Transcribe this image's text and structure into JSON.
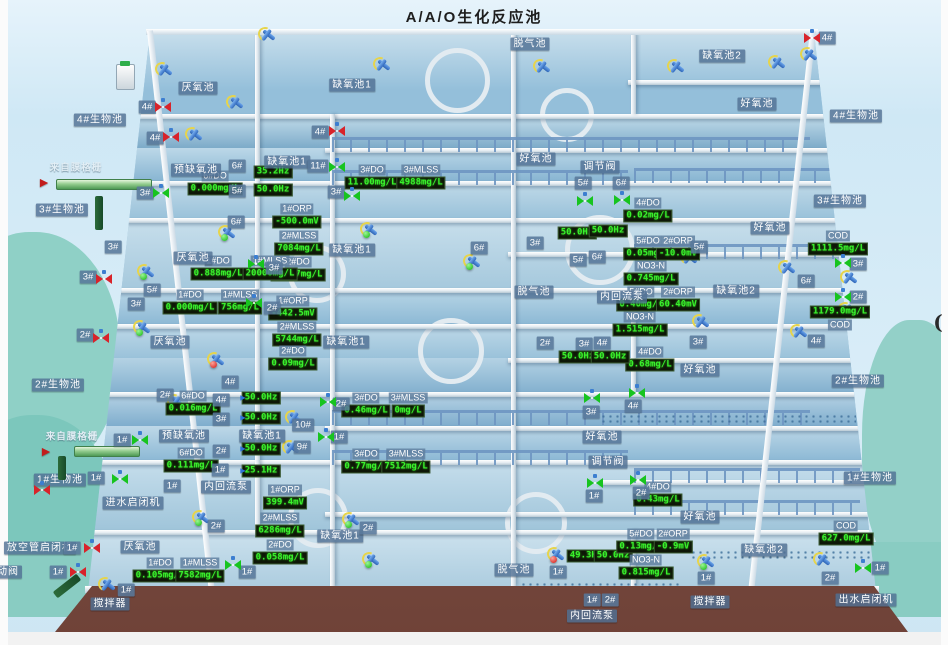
{
  "title": "A/A/O生化反应池",
  "colors": {
    "led_text": "#39f12c",
    "led_bg": "#0e1607",
    "tag_bg": "#58789a",
    "valve_open": "#17c41f",
    "valve_closed": "#d8232a",
    "status_ok": "#0fb30c",
    "status_alarm": "#d01310",
    "water": "#9dc3da"
  },
  "labels": [
    {
      "text": "脱气池",
      "x": 530,
      "y": 44
    },
    {
      "text": "缺氧池2",
      "x": 722,
      "y": 56
    },
    {
      "text": "缺氧池1",
      "x": 352,
      "y": 85
    },
    {
      "text": "厌氧池",
      "x": 198,
      "y": 88
    },
    {
      "text": "好氧池",
      "x": 757,
      "y": 104
    },
    {
      "text": "4#生物池",
      "x": 100,
      "y": 120
    },
    {
      "text": "4#生物池",
      "x": 856,
      "y": 116
    },
    {
      "text": "好氧池",
      "x": 536,
      "y": 159
    },
    {
      "text": "调节阀",
      "x": 600,
      "y": 167
    },
    {
      "text": "缺氧池1",
      "x": 287,
      "y": 162
    },
    {
      "text": "预缺氧池",
      "x": 196,
      "y": 170
    },
    {
      "text": "来自膜格栅",
      "x": 76,
      "y": 168,
      "variant": "plain"
    },
    {
      "text": "3#生物池",
      "x": 62,
      "y": 210
    },
    {
      "text": "3#生物池",
      "x": 840,
      "y": 201
    },
    {
      "text": "好氧池",
      "x": 770,
      "y": 228
    },
    {
      "text": "厌氧池",
      "x": 193,
      "y": 258
    },
    {
      "text": "缺氧池1",
      "x": 352,
      "y": 250
    },
    {
      "text": "脱气池",
      "x": 534,
      "y": 292
    },
    {
      "text": "内回流泵",
      "x": 622,
      "y": 297
    },
    {
      "text": "缺氧池2",
      "x": 736,
      "y": 291
    },
    {
      "text": "厌氧池",
      "x": 170,
      "y": 342
    },
    {
      "text": "缺氧池1",
      "x": 346,
      "y": 342
    },
    {
      "text": "好氧池",
      "x": 700,
      "y": 370
    },
    {
      "text": "2#生物池",
      "x": 58,
      "y": 385
    },
    {
      "text": "2#生物池",
      "x": 858,
      "y": 381
    },
    {
      "text": "预缺氧池",
      "x": 184,
      "y": 436
    },
    {
      "text": "缺氧池1",
      "x": 262,
      "y": 436
    },
    {
      "text": "好氧池",
      "x": 602,
      "y": 437
    },
    {
      "text": "调节阀",
      "x": 608,
      "y": 462
    },
    {
      "text": "来自膜格栅",
      "x": 72,
      "y": 437,
      "variant": "plain"
    },
    {
      "text": "1#生物池",
      "x": 60,
      "y": 480
    },
    {
      "text": "1#生物池",
      "x": 870,
      "y": 478
    },
    {
      "text": "内回流泵",
      "x": 226,
      "y": 487
    },
    {
      "text": "进水启闭机",
      "x": 133,
      "y": 503
    },
    {
      "text": "厌氧池",
      "x": 140,
      "y": 547
    },
    {
      "text": "缺氧池1",
      "x": 340,
      "y": 536
    },
    {
      "text": "好氧池",
      "x": 700,
      "y": 517
    },
    {
      "text": "脱气池",
      "x": 514,
      "y": 570
    },
    {
      "text": "缺氧池2",
      "x": 764,
      "y": 550
    },
    {
      "text": "放空管启闭机",
      "x": 40,
      "y": 548
    },
    {
      "text": "放空管电动阀",
      "x": -14,
      "y": 572
    },
    {
      "text": "搅拌器",
      "x": 110,
      "y": 604
    },
    {
      "text": "内回流泵",
      "x": 592,
      "y": 616
    },
    {
      "text": "搅拌器",
      "x": 710,
      "y": 602
    },
    {
      "text": "出水启闭机",
      "x": 866,
      "y": 600
    },
    {
      "text": "(",
      "x": 938,
      "y": 322,
      "variant": "mark"
    },
    {
      "text": "4#",
      "x": 147,
      "y": 107
    },
    {
      "text": "4#",
      "x": 155,
      "y": 138
    },
    {
      "text": "4#",
      "x": 320,
      "y": 132
    },
    {
      "text": "4#",
      "x": 827,
      "y": 38
    },
    {
      "text": "3#",
      "x": 145,
      "y": 193
    },
    {
      "text": "6#",
      "x": 237,
      "y": 166
    },
    {
      "text": "5#",
      "x": 237,
      "y": 191
    },
    {
      "text": "11#",
      "x": 318,
      "y": 166
    },
    {
      "text": "3#",
      "x": 336,
      "y": 192
    },
    {
      "text": "5#",
      "x": 583,
      "y": 183
    },
    {
      "text": "6#",
      "x": 621,
      "y": 183
    },
    {
      "text": "3#",
      "x": 113,
      "y": 247
    },
    {
      "text": "3#",
      "x": 88,
      "y": 277
    },
    {
      "text": "2#",
      "x": 85,
      "y": 335
    },
    {
      "text": "6#",
      "x": 236,
      "y": 222
    },
    {
      "text": "5#",
      "x": 152,
      "y": 290
    },
    {
      "text": "3#",
      "x": 274,
      "y": 268
    },
    {
      "text": "2#",
      "x": 272,
      "y": 308
    },
    {
      "text": "3#",
      "x": 136,
      "y": 304
    },
    {
      "text": "6#",
      "x": 479,
      "y": 248
    },
    {
      "text": "3#",
      "x": 535,
      "y": 243
    },
    {
      "text": "5#",
      "x": 578,
      "y": 260
    },
    {
      "text": "6#",
      "x": 597,
      "y": 257
    },
    {
      "text": "2#",
      "x": 545,
      "y": 343
    },
    {
      "text": "3#",
      "x": 584,
      "y": 344
    },
    {
      "text": "4#",
      "x": 602,
      "y": 343
    },
    {
      "text": "5#",
      "x": 699,
      "y": 247
    },
    {
      "text": "3#",
      "x": 698,
      "y": 342
    },
    {
      "text": "6#",
      "x": 806,
      "y": 281
    },
    {
      "text": "4#",
      "x": 816,
      "y": 341
    },
    {
      "text": "3#",
      "x": 858,
      "y": 264
    },
    {
      "text": "2#",
      "x": 858,
      "y": 297
    },
    {
      "text": "4#",
      "x": 230,
      "y": 382
    },
    {
      "text": "2#",
      "x": 165,
      "y": 395
    },
    {
      "text": "4#",
      "x": 221,
      "y": 400
    },
    {
      "text": "3#",
      "x": 221,
      "y": 419
    },
    {
      "text": "2#",
      "x": 221,
      "y": 451
    },
    {
      "text": "1#",
      "x": 220,
      "y": 470
    },
    {
      "text": "1#",
      "x": 122,
      "y": 440
    },
    {
      "text": "1#",
      "x": 96,
      "y": 478
    },
    {
      "text": "10#",
      "x": 303,
      "y": 425
    },
    {
      "text": "9#",
      "x": 302,
      "y": 447
    },
    {
      "text": "1#",
      "x": 172,
      "y": 486
    },
    {
      "text": "2#",
      "x": 341,
      "y": 404
    },
    {
      "text": "1#",
      "x": 339,
      "y": 437
    },
    {
      "text": "3#",
      "x": 591,
      "y": 412
    },
    {
      "text": "1#",
      "x": 594,
      "y": 496
    },
    {
      "text": "4#",
      "x": 633,
      "y": 406
    },
    {
      "text": "2#",
      "x": 641,
      "y": 493
    },
    {
      "text": "2#",
      "x": 216,
      "y": 526
    },
    {
      "text": "2#",
      "x": 368,
      "y": 528
    },
    {
      "text": "1#",
      "x": 126,
      "y": 590
    },
    {
      "text": "1#",
      "x": 72,
      "y": 548
    },
    {
      "text": "1#",
      "x": 58,
      "y": 572
    },
    {
      "text": "1#",
      "x": 247,
      "y": 572
    },
    {
      "text": "1#",
      "x": 558,
      "y": 572
    },
    {
      "text": "1#",
      "x": 592,
      "y": 600
    },
    {
      "text": "2#",
      "x": 610,
      "y": 600
    },
    {
      "text": "1#",
      "x": 706,
      "y": 578
    },
    {
      "text": "1#",
      "x": 880,
      "y": 568
    },
    {
      "text": "2#",
      "x": 830,
      "y": 578
    }
  ],
  "sensors": [
    {
      "label": "6#DO",
      "value": "0.000mg/L",
      "x": 215,
      "y": 183
    },
    {
      "value": "35.2Hz",
      "x": 273,
      "y": 172
    },
    {
      "value": "50.0Hz",
      "x": 273,
      "y": 190
    },
    {
      "label": "3#DO",
      "value": "11.00mg/L",
      "x": 372,
      "y": 177
    },
    {
      "label": "3#MLSS",
      "value": "4988mg/L",
      "x": 421,
      "y": 177
    },
    {
      "label": "1#ORP",
      "value": "-500.0mV",
      "x": 297,
      "y": 216
    },
    {
      "label": "2#MLSS",
      "value": "7084mg/L",
      "x": 299,
      "y": 243
    },
    {
      "label": "2#DO",
      "value": "10.17mg/L",
      "x": 298,
      "y": 269
    },
    {
      "label": "1#DO",
      "value": "0.888mg/L",
      "x": 218,
      "y": 268
    },
    {
      "label": "1#MLSS",
      "value": "20000mg/L",
      "x": 270,
      "y": 268
    },
    {
      "label": "1#DO",
      "value": "0.000mg/L",
      "x": 190,
      "y": 302
    },
    {
      "label": "1#MLSS",
      "value": "756mg/L",
      "x": 240,
      "y": 302
    },
    {
      "label": "1#ORP",
      "value": "-442.5mV",
      "x": 293,
      "y": 308
    },
    {
      "label": "2#MLSS",
      "value": "5744mg/L",
      "x": 297,
      "y": 334
    },
    {
      "label": "2#DO",
      "value": "0.09mg/L",
      "x": 293,
      "y": 358
    },
    {
      "label": "4#DO",
      "value": "0.02mg/L",
      "x": 648,
      "y": 210
    },
    {
      "value": "50.0Hz",
      "x": 577,
      "y": 233
    },
    {
      "value": "50.0Hz",
      "x": 608,
      "y": 231
    },
    {
      "label": "5#DO",
      "value": "0.05mg/L",
      "x": 648,
      "y": 248
    },
    {
      "label": "2#ORP",
      "value": "-10.0mV",
      "x": 678,
      "y": 248
    },
    {
      "label": "NO3-N",
      "value": "0.745mg/L",
      "x": 651,
      "y": 273
    },
    {
      "label": "COD",
      "value": "1111.5mg/L",
      "x": 838,
      "y": 243
    },
    {
      "label": "5#DO",
      "value": "0.40mg/L",
      "x": 641,
      "y": 299
    },
    {
      "label": "2#ORP",
      "value": "60.40mV",
      "x": 678,
      "y": 299
    },
    {
      "label": "NO3-N",
      "value": "1.515mg/L",
      "x": 640,
      "y": 324
    },
    {
      "label": "COD",
      "value": "1179.0mg/L",
      "x": 840,
      "y": 318,
      "label_pos": "below"
    },
    {
      "label": "4#DO",
      "value": "0.68mg/L",
      "x": 650,
      "y": 359
    },
    {
      "value": "50.0Hz",
      "x": 578,
      "y": 357
    },
    {
      "value": "50.0Hz",
      "x": 610,
      "y": 357
    },
    {
      "label": "6#DO",
      "value": "0.016mg/L",
      "x": 193,
      "y": 403
    },
    {
      "value": "50.0Hz",
      "x": 261,
      "y": 398
    },
    {
      "value": "50.0Hz",
      "x": 261,
      "y": 418
    },
    {
      "value": "50.0Hz",
      "x": 261,
      "y": 449
    },
    {
      "value": "25.1Hz",
      "x": 261,
      "y": 471
    },
    {
      "label": "6#DO",
      "value": "0.111mg/L",
      "x": 191,
      "y": 460
    },
    {
      "label": "3#DO",
      "value": "0.46mg/L",
      "x": 366,
      "y": 405
    },
    {
      "label": "3#MLSS",
      "value": "0mg/L",
      "x": 408,
      "y": 405
    },
    {
      "label": "3#DO",
      "value": "0.77mg/L",
      "x": 366,
      "y": 461
    },
    {
      "label": "3#MLSS",
      "value": "7512mg/L",
      "x": 406,
      "y": 461
    },
    {
      "label": "1#ORP",
      "value": "399.4mV",
      "x": 285,
      "y": 497
    },
    {
      "label": "2#MLSS",
      "value": "6286mg/L",
      "x": 280,
      "y": 525
    },
    {
      "label": "2#DO",
      "value": "0.058mg/L",
      "x": 280,
      "y": 552
    },
    {
      "label": "4#DO",
      "value": "0.43mg/L",
      "x": 658,
      "y": 494
    },
    {
      "label": "1#DO",
      "value": "0.105mg/L",
      "x": 160,
      "y": 570
    },
    {
      "label": "1#MLSS",
      "value": "7582mg/L",
      "x": 200,
      "y": 570
    },
    {
      "value": "49.3Hz",
      "x": 586,
      "y": 556
    },
    {
      "value": "50.0Hz",
      "x": 613,
      "y": 556
    },
    {
      "label": "5#DO",
      "value": "0.13mg/L",
      "x": 641,
      "y": 541
    },
    {
      "label": "2#ORP",
      "value": "-0.9mV",
      "x": 673,
      "y": 541
    },
    {
      "label": "NO3-N",
      "value": "0.815mg/L",
      "x": 646,
      "y": 567
    },
    {
      "label": "COD",
      "value": "627.0mg/L",
      "x": 846,
      "y": 533
    }
  ],
  "valves": [
    {
      "x": 163,
      "y": 107,
      "state": "closed"
    },
    {
      "x": 171,
      "y": 137,
      "state": "closed"
    },
    {
      "x": 337,
      "y": 131,
      "state": "closed"
    },
    {
      "x": 812,
      "y": 38,
      "state": "closed"
    },
    {
      "x": 104,
      "y": 279,
      "state": "closed"
    },
    {
      "x": 101,
      "y": 338,
      "state": "closed"
    },
    {
      "x": 42,
      "y": 490,
      "state": "closed"
    },
    {
      "x": 92,
      "y": 548,
      "state": "closed"
    },
    {
      "x": 78,
      "y": 572,
      "state": "closed"
    },
    {
      "x": 161,
      "y": 193,
      "state": "open"
    },
    {
      "x": 337,
      "y": 167,
      "state": "open"
    },
    {
      "x": 352,
      "y": 196,
      "state": "open"
    },
    {
      "x": 585,
      "y": 201,
      "state": "open"
    },
    {
      "x": 622,
      "y": 200,
      "state": "open"
    },
    {
      "x": 256,
      "y": 264,
      "state": "open"
    },
    {
      "x": 254,
      "y": 303,
      "state": "open"
    },
    {
      "x": 843,
      "y": 263,
      "state": "open"
    },
    {
      "x": 843,
      "y": 297,
      "state": "open"
    },
    {
      "x": 637,
      "y": 393,
      "state": "open"
    },
    {
      "x": 638,
      "y": 480,
      "state": "open"
    },
    {
      "x": 592,
      "y": 398,
      "state": "open"
    },
    {
      "x": 595,
      "y": 483,
      "state": "open"
    },
    {
      "x": 328,
      "y": 402,
      "state": "open"
    },
    {
      "x": 326,
      "y": 437,
      "state": "open"
    },
    {
      "x": 140,
      "y": 440,
      "state": "open"
    },
    {
      "x": 120,
      "y": 479,
      "state": "open"
    },
    {
      "x": 233,
      "y": 565,
      "state": "open"
    },
    {
      "x": 863,
      "y": 568,
      "state": "open"
    }
  ],
  "mixers": [
    {
      "x": 268,
      "y": 35
    },
    {
      "x": 383,
      "y": 65
    },
    {
      "x": 543,
      "y": 67
    },
    {
      "x": 677,
      "y": 67
    },
    {
      "x": 778,
      "y": 63
    },
    {
      "x": 810,
      "y": 55
    },
    {
      "x": 165,
      "y": 70
    },
    {
      "x": 236,
      "y": 103
    },
    {
      "x": 195,
      "y": 135
    },
    {
      "x": 228,
      "y": 233,
      "status": "ok"
    },
    {
      "x": 147,
      "y": 272,
      "status": "ok"
    },
    {
      "x": 143,
      "y": 328,
      "status": "ok"
    },
    {
      "x": 217,
      "y": 360,
      "status": "alarm"
    },
    {
      "x": 370,
      "y": 230,
      "status": "ok"
    },
    {
      "x": 473,
      "y": 262,
      "status": "ok"
    },
    {
      "x": 690,
      "y": 258
    },
    {
      "x": 702,
      "y": 322
    },
    {
      "x": 788,
      "y": 268
    },
    {
      "x": 800,
      "y": 332
    },
    {
      "x": 850,
      "y": 278
    },
    {
      "x": 848,
      "y": 310
    },
    {
      "x": 177,
      "y": 402
    },
    {
      "x": 295,
      "y": 418
    },
    {
      "x": 292,
      "y": 448
    },
    {
      "x": 202,
      "y": 518,
      "status": "ok"
    },
    {
      "x": 352,
      "y": 520,
      "status": "ok"
    },
    {
      "x": 372,
      "y": 560,
      "status": "ok"
    },
    {
      "x": 557,
      "y": 555,
      "status": "alarm"
    },
    {
      "x": 707,
      "y": 562,
      "status": "ok"
    },
    {
      "x": 823,
      "y": 560
    },
    {
      "x": 108,
      "y": 585
    }
  ],
  "arrows": [
    {
      "x": 44,
      "y": 182,
      "variant": "inflow"
    },
    {
      "x": 46,
      "y": 451,
      "variant": "inflow"
    },
    {
      "x": 243,
      "y": 398,
      "variant": "pump"
    },
    {
      "x": 243,
      "y": 418,
      "variant": "pump"
    },
    {
      "x": 243,
      "y": 449,
      "variant": "pump"
    },
    {
      "x": 243,
      "y": 471,
      "variant": "pump"
    }
  ],
  "pipes": [
    {
      "x": 56,
      "y": 179,
      "w": 94,
      "h": 9
    },
    {
      "x": 74,
      "y": 446,
      "w": 64,
      "h": 9
    }
  ]
}
